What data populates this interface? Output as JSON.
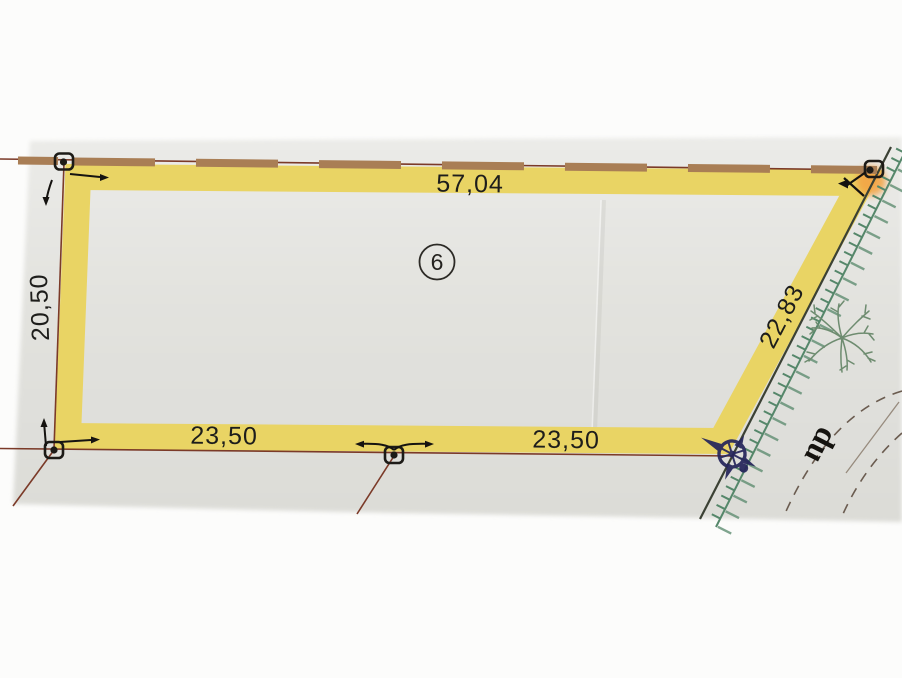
{
  "plan": {
    "parcel_number": "6",
    "dimensions": {
      "top": "57,04",
      "left": "20,50",
      "bottom_left": "23,50",
      "bottom_right": "23,50",
      "right_diagonal": "22,83"
    },
    "street_label": "du",
    "colors": {
      "background": "#fcfcfb",
      "paper": "#e2e2de",
      "parcel_band": "#e9d464",
      "boundary_line": "#7b3a28",
      "wall_dash": "#a97e55",
      "road_line": "#3b4134",
      "hatch_green": "#55876a",
      "tree_green": "#6e8c70",
      "compass_navy": "#26265c",
      "corner_highlight": "#f2a444",
      "label_text": "#1d1d1b"
    }
  }
}
